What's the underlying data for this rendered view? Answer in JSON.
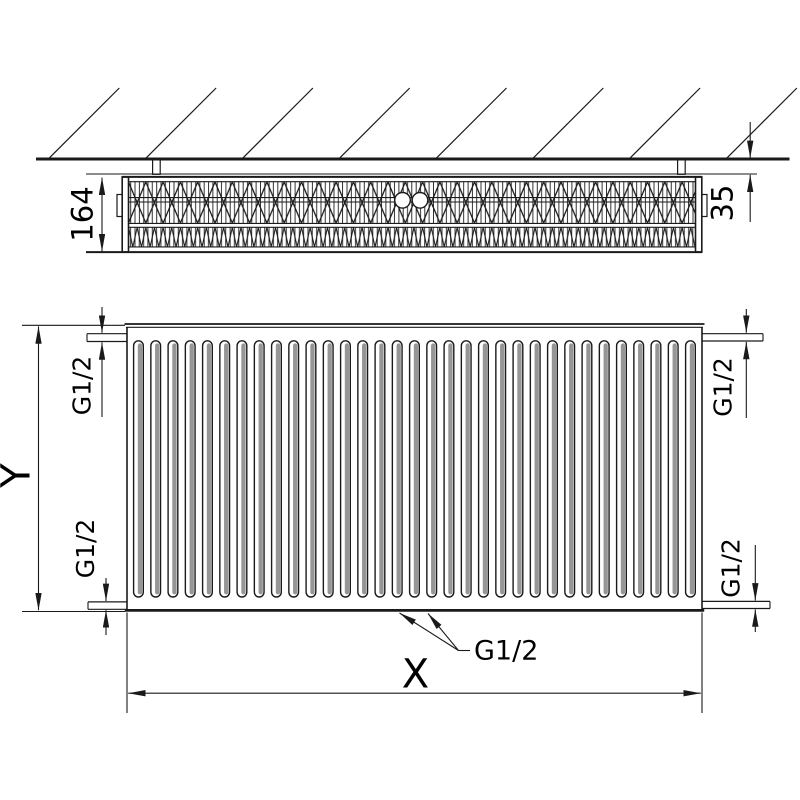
{
  "drawing": {
    "side_view": {
      "depth_label": "164",
      "wall_distance_label": "35"
    },
    "front_view": {
      "height_label": "Y",
      "width_label": "X",
      "connections": {
        "top_left": "G1/2",
        "top_right": "G1/2",
        "bottom_left": "G1/2",
        "bottom_right": "G1/2",
        "bottom_center": "G1/2"
      }
    },
    "colors": {
      "line": "#1a1a1a",
      "groove_shadow": "#969696",
      "background": "#ffffff"
    }
  }
}
